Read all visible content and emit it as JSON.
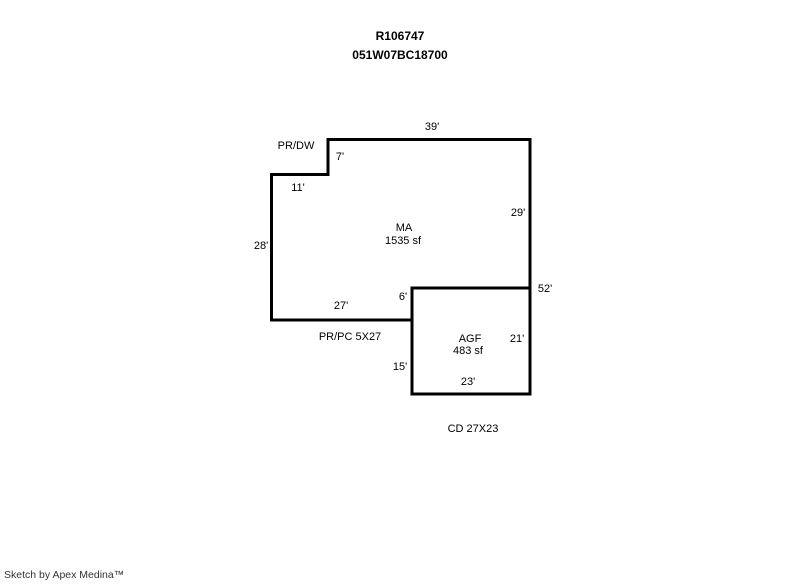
{
  "header": {
    "account": "R106747",
    "parcel": "051W07BC18700"
  },
  "sketch": {
    "areas": [
      {
        "code": "MA",
        "area": "1535 sf"
      },
      {
        "code": "AGF",
        "area": "483 sf"
      }
    ],
    "labels": {
      "top_width": "39'",
      "porch_dw": "PR/DW",
      "notch_height": "7'",
      "notch_width": "11'",
      "right_upper": "29'",
      "ma_code": "MA",
      "ma_area": "1535 sf",
      "left_height": "28'",
      "step_height": "6'",
      "ma_bottom_width": "27'",
      "right_total": "52'",
      "porch_pc": "PR/PC 5X27",
      "agf_code": "AGF",
      "agf_area": "483 sf",
      "agf_right": "21'",
      "agf_left": "15'",
      "agf_bottom": "23'",
      "carport": "CD 27X23"
    },
    "colors": {
      "outline": "#000000",
      "text": "#000000",
      "background": "#ffffff"
    }
  },
  "footer": {
    "credit": "Sketch by Apex Medina™"
  }
}
